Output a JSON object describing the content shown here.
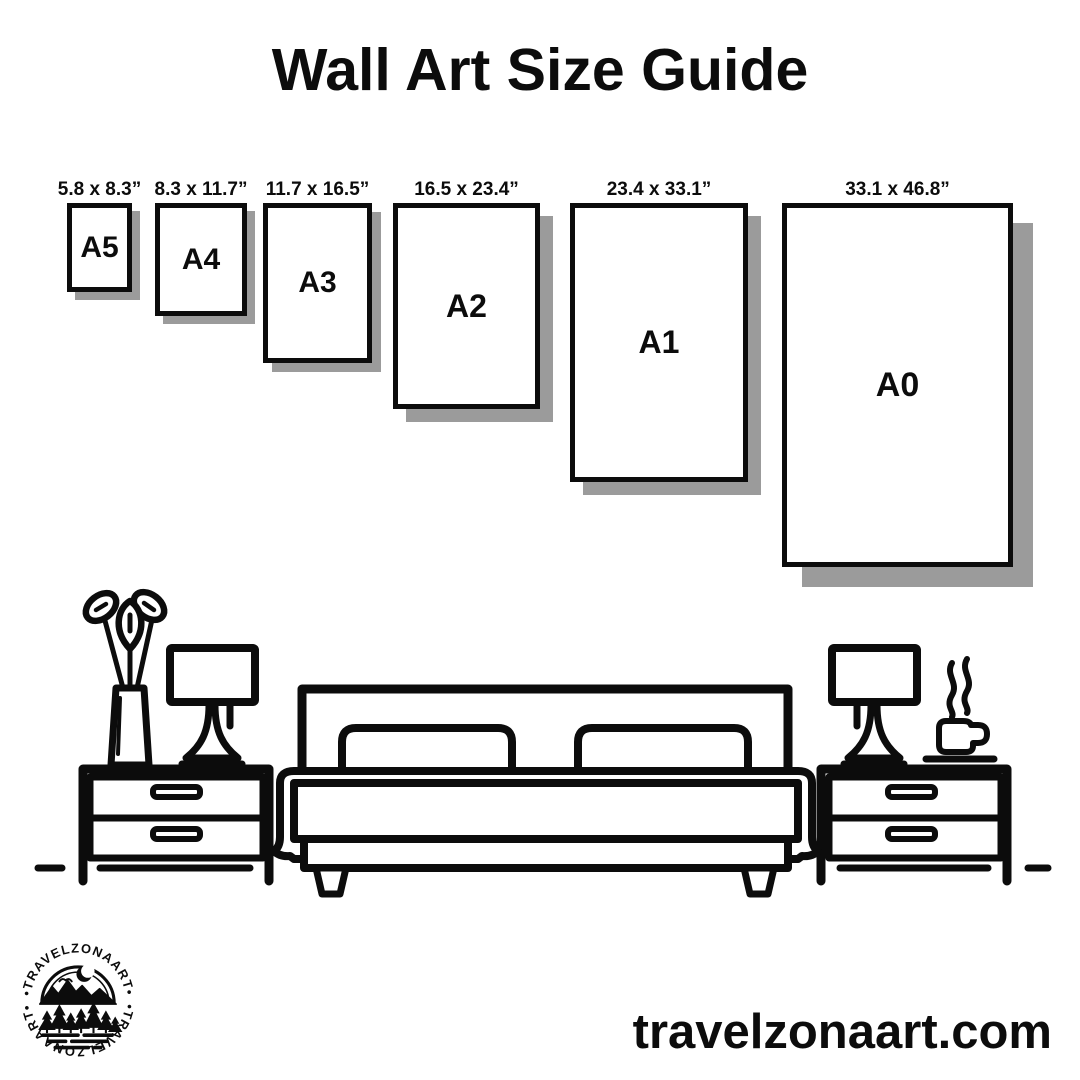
{
  "title": "Wall Art Size Guide",
  "sizes": [
    {
      "label": "A5",
      "dims": "5.8 x 8.3”"
    },
    {
      "label": "A4",
      "dims": "8.3 x 11.7”"
    },
    {
      "label": "A3",
      "dims": "11.7 x 16.5”"
    },
    {
      "label": "A2",
      "dims": "16.5 x 23.4”"
    },
    {
      "label": "A1",
      "dims": "23.4 x 33.1”"
    },
    {
      "label": "A0",
      "dims": "33.1 x 46.8”"
    }
  ],
  "footer": {
    "website": "travelzonaart.com"
  },
  "logo": {
    "arc_top": "•TRAVELZONAART•",
    "arc_bottom": "•TRAVELZONAART•"
  },
  "colors": {
    "ink": "#0c0c0c",
    "shadow": "#9b9b9b",
    "background": "#ffffff"
  },
  "illustration": {
    "icons": [
      "plant-vase-icon",
      "table-lamp-icon",
      "nightstand-icon",
      "double-bed-icon",
      "pillow-icon",
      "coffee-cup-icon",
      "steam-icon",
      "floor-line"
    ]
  }
}
